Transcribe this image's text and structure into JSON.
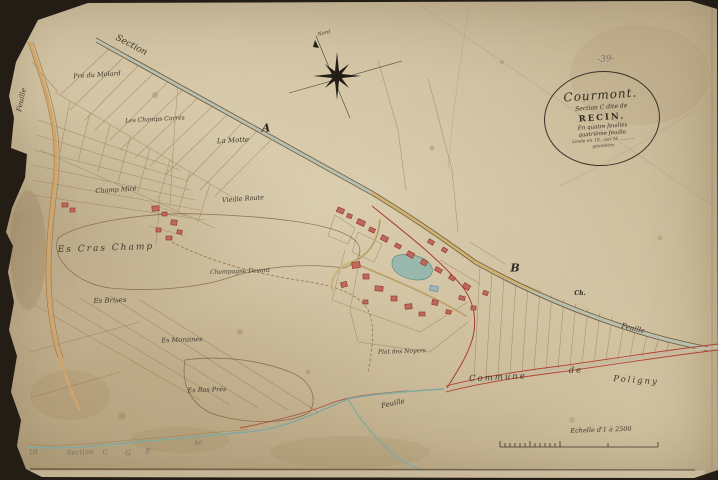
{
  "cartouche": {
    "sheet_number": "-39-",
    "commune": "Courmont.",
    "section_line": "Section C dite de",
    "lieu": "RECIN.",
    "feuilles_line1": "En quatre feuilles",
    "feuilles_line2": "quatrième feuille.",
    "surveyor_line1": "Levée en 18.. par M. ..........",
    "surveyor_line2": "géomètre."
  },
  "compass": {
    "north_label": "Nord"
  },
  "scale": {
    "caption": "Echelle d'1 à 2500"
  },
  "map": {
    "colors": {
      "paper": "#d2c4a4",
      "ink": "#3a332b",
      "parcel_line": "#8f7248",
      "boundary_red": "#a93c30",
      "water": "#7fa8a0",
      "road_yellow": "#d4ae62",
      "building_red": "#c0685c",
      "building_blue": "#9db8c2"
    },
    "labels": [
      {
        "t": "Section",
        "x": 131,
        "y": 46,
        "r": 28,
        "s": 9,
        "c": "script"
      },
      {
        "t": "Pré du Molard",
        "x": 97,
        "y": 75,
        "r": -4,
        "s": 6.5,
        "c": "script"
      },
      {
        "t": "Les Champs Carrés",
        "x": 155,
        "y": 120,
        "r": -3,
        "s": 6,
        "c": "script"
      },
      {
        "t": "La Motte",
        "x": 233,
        "y": 141,
        "r": -3,
        "s": 7,
        "c": "script"
      },
      {
        "t": "Champ Miré",
        "x": 116,
        "y": 190,
        "r": -3,
        "s": 6.5,
        "c": "script"
      },
      {
        "t": "Vieille Route",
        "x": 243,
        "y": 199,
        "r": -4,
        "s": 6.5,
        "c": "script"
      },
      {
        "t": "Es Cras Champ",
        "x": 106,
        "y": 249,
        "r": -2,
        "s": 9,
        "c": "script wide"
      },
      {
        "t": "Champagne Devant",
        "x": 240,
        "y": 272,
        "r": -2,
        "s": 6,
        "c": "script"
      },
      {
        "t": "Es Brises",
        "x": 110,
        "y": 301,
        "r": -2,
        "s": 7,
        "c": "script"
      },
      {
        "t": "Es Moraines",
        "x": 182,
        "y": 340,
        "r": -2,
        "s": 6.5,
        "c": "script"
      },
      {
        "t": "Es Bas Prés",
        "x": 207,
        "y": 390,
        "r": -2,
        "s": 6.5,
        "c": "script"
      },
      {
        "t": "Plat des Noyers",
        "x": 402,
        "y": 352,
        "r": -2,
        "s": 6,
        "c": "script"
      },
      {
        "t": "Commune",
        "x": 498,
        "y": 378,
        "r": -3,
        "s": 8.5,
        "c": "script wide"
      },
      {
        "t": "de",
        "x": 576,
        "y": 371,
        "r": -3,
        "s": 8.5,
        "c": "script wide"
      },
      {
        "t": "Poligny",
        "x": 636,
        "y": 381,
        "r": 4,
        "s": 8.5,
        "c": "script wide"
      },
      {
        "t": "Feuille",
        "x": 633,
        "y": 329,
        "r": 13,
        "s": 7,
        "c": "script"
      },
      {
        "t": "Feuille",
        "x": 393,
        "y": 404,
        "r": -12,
        "s": 7,
        "c": "script"
      },
      {
        "t": "Feuille",
        "x": 22,
        "y": 100,
        "r": -78,
        "s": 7,
        "c": "script"
      },
      {
        "t": "Nord",
        "x": 324,
        "y": 34,
        "r": -12,
        "s": 5,
        "c": "script"
      },
      {
        "t": "A",
        "x": 266,
        "y": 128,
        "r": 0,
        "s": 11,
        "c": "serifbold"
      },
      {
        "t": "B",
        "x": 515,
        "y": 268,
        "r": 0,
        "s": 11,
        "c": "serifbold"
      },
      {
        "t": "Ch.",
        "x": 580,
        "y": 294,
        "r": 0,
        "s": 6,
        "c": "serifbold"
      },
      {
        "t": "-39-",
        "x": 606,
        "y": 60,
        "r": -4,
        "s": 9,
        "c": "pencil"
      },
      {
        "t": "10",
        "x": 33,
        "y": 453,
        "r": 0,
        "s": 7,
        "c": "pencil"
      },
      {
        "t": "Section",
        "x": 80,
        "y": 453,
        "r": -2,
        "s": 7,
        "c": "pencil"
      },
      {
        "t": "C",
        "x": 105,
        "y": 453,
        "r": 0,
        "s": 7,
        "c": "pencil"
      },
      {
        "t": "G",
        "x": 128,
        "y": 454,
        "r": 0,
        "s": 7,
        "c": "pencil"
      },
      {
        "t": "E",
        "x": 148,
        "y": 452,
        "r": 0,
        "s": 7,
        "c": "pencil"
      },
      {
        "t": "4e",
        "x": 198,
        "y": 443,
        "r": -8,
        "s": 7,
        "c": "pencil"
      },
      {
        "t": "Echelle d'1 à 2500",
        "x": 601,
        "y": 430,
        "r": -2,
        "s": 6.5,
        "c": "script"
      }
    ],
    "buildings": [
      {
        "x": 337,
        "y": 208,
        "w": 7,
        "h": 5,
        "r": 22
      },
      {
        "x": 347,
        "y": 214,
        "w": 5,
        "h": 4,
        "r": 22
      },
      {
        "x": 357,
        "y": 220,
        "w": 8,
        "h": 5,
        "r": 25
      },
      {
        "x": 369,
        "y": 228,
        "w": 6,
        "h": 4,
        "r": 25
      },
      {
        "x": 381,
        "y": 236,
        "w": 7,
        "h": 5,
        "r": 27
      },
      {
        "x": 395,
        "y": 244,
        "w": 6,
        "h": 4,
        "r": 27
      },
      {
        "x": 407,
        "y": 252,
        "w": 7,
        "h": 5,
        "r": 29
      },
      {
        "x": 421,
        "y": 260,
        "w": 6,
        "h": 5,
        "r": 29
      },
      {
        "x": 435,
        "y": 268,
        "w": 7,
        "h": 4,
        "r": 30
      },
      {
        "x": 449,
        "y": 276,
        "w": 6,
        "h": 4,
        "r": 31
      },
      {
        "x": 463,
        "y": 284,
        "w": 7,
        "h": 5,
        "r": 31
      },
      {
        "x": 428,
        "y": 240,
        "w": 6,
        "h": 4,
        "r": 29
      },
      {
        "x": 442,
        "y": 248,
        "w": 5,
        "h": 4,
        "r": 30
      },
      {
        "x": 352,
        "y": 262,
        "w": 8,
        "h": 6,
        "r": -8
      },
      {
        "x": 363,
        "y": 274,
        "w": 6,
        "h": 5,
        "r": 0
      },
      {
        "x": 375,
        "y": 286,
        "w": 8,
        "h": 5,
        "r": 5
      },
      {
        "x": 391,
        "y": 296,
        "w": 6,
        "h": 5,
        "r": 0
      },
      {
        "x": 405,
        "y": 304,
        "w": 7,
        "h": 5,
        "r": -5
      },
      {
        "x": 419,
        "y": 312,
        "w": 6,
        "h": 4,
        "r": 0
      },
      {
        "x": 363,
        "y": 300,
        "w": 5,
        "h": 4,
        "r": 0
      },
      {
        "x": 341,
        "y": 282,
        "w": 6,
        "h": 5,
        "r": -14
      },
      {
        "x": 432,
        "y": 300,
        "w": 6,
        "h": 5,
        "r": 10
      },
      {
        "x": 446,
        "y": 310,
        "w": 5,
        "h": 4,
        "r": 10
      },
      {
        "x": 459,
        "y": 296,
        "w": 6,
        "h": 4,
        "r": 14
      },
      {
        "x": 471,
        "y": 306,
        "w": 5,
        "h": 4,
        "r": 0
      },
      {
        "x": 483,
        "y": 291,
        "w": 5,
        "h": 4,
        "r": 20
      },
      {
        "x": 152,
        "y": 206,
        "w": 7,
        "h": 5,
        "r": -5
      },
      {
        "x": 162,
        "y": 212,
        "w": 5,
        "h": 4,
        "r": 0
      },
      {
        "x": 171,
        "y": 220,
        "w": 6,
        "h": 5,
        "r": 6
      },
      {
        "x": 156,
        "y": 228,
        "w": 5,
        "h": 4,
        "r": 0
      },
      {
        "x": 166,
        "y": 236,
        "w": 6,
        "h": 4,
        "r": 0
      },
      {
        "x": 177,
        "y": 230,
        "w": 5,
        "h": 4,
        "r": 10
      },
      {
        "x": 62,
        "y": 203,
        "w": 6,
        "h": 4,
        "r": 0
      },
      {
        "x": 70,
        "y": 208,
        "w": 5,
        "h": 4,
        "r": 0
      },
      {
        "x": 430,
        "y": 286,
        "w": 8,
        "h": 5,
        "r": 10,
        "c": "blue"
      }
    ]
  }
}
